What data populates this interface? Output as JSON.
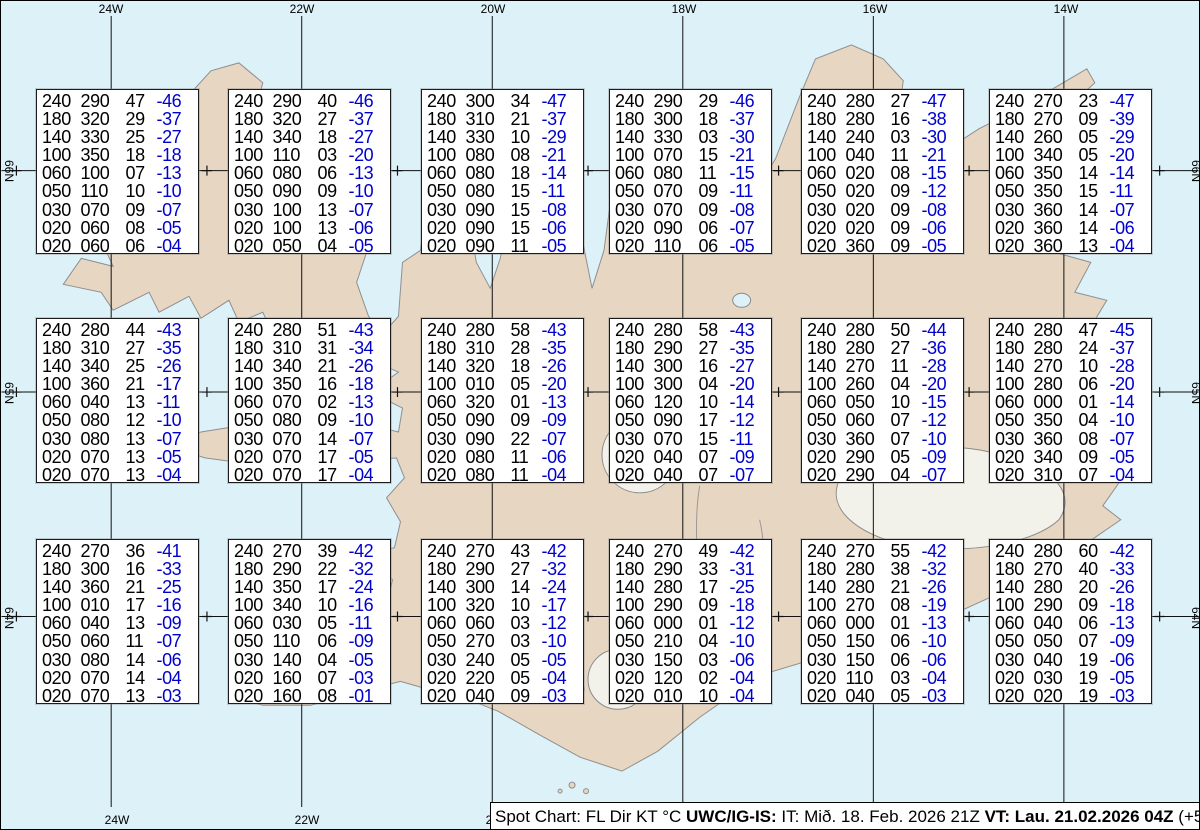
{
  "title": "Spot Chart",
  "colors": {
    "ocean": "#ddf1f8",
    "land": "#e7d6c2",
    "coastline": "#8f8f8f",
    "glacier": "#f2f1ea",
    "temperature_text": "#0000cc",
    "grid": "#111111",
    "box_background": "#ffffff"
  },
  "grid": {
    "top_labels": [
      "24W",
      "22W",
      "20W",
      "18W",
      "16W",
      "14W"
    ],
    "bottom_labels": [
      "24W",
      "22W",
      "20W",
      "18W",
      "16W",
      "14W"
    ],
    "left_labels": [
      "66N",
      "65N",
      "64N"
    ],
    "right_labels": [
      "66N",
      "65N",
      "64N"
    ]
  },
  "columns": [
    "FL",
    "Dir",
    "KT",
    "°C"
  ],
  "status_bar": {
    "segments": [
      {
        "text": "Spot Chart: FL Dir KT °C ",
        "bold": false
      },
      {
        "text": "UWC/IG-IS:",
        "bold": true
      },
      {
        "text": " IT: Mið. 18. Feb. 2026 21Z ",
        "bold": false
      },
      {
        "text": "VT: Lau. 21.02.2026 04Z",
        "bold": true
      },
      {
        "text": " (+55 h)",
        "bold": false
      }
    ]
  },
  "stations": [
    {
      "rows": [
        [
          "240",
          "290",
          "47",
          "-46"
        ],
        [
          "180",
          "320",
          "29",
          "-37"
        ],
        [
          "140",
          "330",
          "25",
          "-27"
        ],
        [
          "100",
          "350",
          "18",
          "-18"
        ],
        [
          "060",
          "100",
          "07",
          "-13"
        ],
        [
          "050",
          "110",
          "10",
          "-10"
        ],
        [
          "030",
          "070",
          "09",
          "-07"
        ],
        [
          "020",
          "060",
          "08",
          "-05"
        ],
        [
          "020",
          "060",
          "06",
          "-04"
        ]
      ]
    },
    {
      "rows": [
        [
          "240",
          "290",
          "40",
          "-46"
        ],
        [
          "180",
          "320",
          "27",
          "-37"
        ],
        [
          "140",
          "340",
          "18",
          "-27"
        ],
        [
          "100",
          "110",
          "03",
          "-20"
        ],
        [
          "060",
          "080",
          "06",
          "-13"
        ],
        [
          "050",
          "090",
          "09",
          "-10"
        ],
        [
          "030",
          "100",
          "13",
          "-07"
        ],
        [
          "020",
          "100",
          "13",
          "-06"
        ],
        [
          "020",
          "050",
          "04",
          "-05"
        ]
      ]
    },
    {
      "rows": [
        [
          "240",
          "300",
          "34",
          "-47"
        ],
        [
          "180",
          "310",
          "21",
          "-37"
        ],
        [
          "140",
          "330",
          "10",
          "-29"
        ],
        [
          "100",
          "080",
          "08",
          "-21"
        ],
        [
          "060",
          "080",
          "18",
          "-14"
        ],
        [
          "050",
          "080",
          "15",
          "-11"
        ],
        [
          "030",
          "090",
          "15",
          "-08"
        ],
        [
          "020",
          "090",
          "15",
          "-06"
        ],
        [
          "020",
          "090",
          "11",
          "-05"
        ]
      ]
    },
    {
      "rows": [
        [
          "240",
          "290",
          "29",
          "-46"
        ],
        [
          "180",
          "300",
          "18",
          "-37"
        ],
        [
          "140",
          "330",
          "03",
          "-30"
        ],
        [
          "100",
          "070",
          "15",
          "-21"
        ],
        [
          "060",
          "080",
          "11",
          "-15"
        ],
        [
          "050",
          "070",
          "09",
          "-11"
        ],
        [
          "030",
          "070",
          "09",
          "-08"
        ],
        [
          "020",
          "090",
          "06",
          "-07"
        ],
        [
          "020",
          "110",
          "06",
          "-05"
        ]
      ]
    },
    {
      "rows": [
        [
          "240",
          "280",
          "27",
          "-47"
        ],
        [
          "180",
          "280",
          "16",
          "-38"
        ],
        [
          "140",
          "240",
          "03",
          "-30"
        ],
        [
          "100",
          "040",
          "11",
          "-21"
        ],
        [
          "060",
          "020",
          "08",
          "-15"
        ],
        [
          "050",
          "020",
          "09",
          "-12"
        ],
        [
          "030",
          "020",
          "09",
          "-08"
        ],
        [
          "020",
          "020",
          "09",
          "-06"
        ],
        [
          "020",
          "360",
          "09",
          "-05"
        ]
      ]
    },
    {
      "rows": [
        [
          "240",
          "270",
          "23",
          "-47"
        ],
        [
          "180",
          "270",
          "09",
          "-39"
        ],
        [
          "140",
          "260",
          "05",
          "-29"
        ],
        [
          "100",
          "340",
          "05",
          "-20"
        ],
        [
          "060",
          "350",
          "14",
          "-14"
        ],
        [
          "050",
          "350",
          "15",
          "-11"
        ],
        [
          "030",
          "360",
          "14",
          "-07"
        ],
        [
          "020",
          "360",
          "14",
          "-06"
        ],
        [
          "020",
          "360",
          "13",
          "-04"
        ]
      ]
    },
    {
      "rows": [
        [
          "240",
          "280",
          "44",
          "-43"
        ],
        [
          "180",
          "310",
          "27",
          "-35"
        ],
        [
          "140",
          "340",
          "25",
          "-26"
        ],
        [
          "100",
          "360",
          "21",
          "-17"
        ],
        [
          "060",
          "040",
          "13",
          "-11"
        ],
        [
          "050",
          "080",
          "12",
          "-10"
        ],
        [
          "030",
          "080",
          "13",
          "-07"
        ],
        [
          "020",
          "070",
          "13",
          "-05"
        ],
        [
          "020",
          "070",
          "13",
          "-04"
        ]
      ]
    },
    {
      "rows": [
        [
          "240",
          "280",
          "51",
          "-43"
        ],
        [
          "180",
          "310",
          "31",
          "-34"
        ],
        [
          "140",
          "340",
          "21",
          "-26"
        ],
        [
          "100",
          "350",
          "16",
          "-18"
        ],
        [
          "060",
          "070",
          "02",
          "-13"
        ],
        [
          "050",
          "080",
          "09",
          "-10"
        ],
        [
          "030",
          "070",
          "14",
          "-07"
        ],
        [
          "020",
          "070",
          "17",
          "-05"
        ],
        [
          "020",
          "070",
          "17",
          "-04"
        ]
      ]
    },
    {
      "rows": [
        [
          "240",
          "280",
          "58",
          "-43"
        ],
        [
          "180",
          "310",
          "28",
          "-35"
        ],
        [
          "140",
          "320",
          "18",
          "-26"
        ],
        [
          "100",
          "010",
          "05",
          "-20"
        ],
        [
          "060",
          "320",
          "01",
          "-13"
        ],
        [
          "050",
          "090",
          "09",
          "-09"
        ],
        [
          "030",
          "090",
          "22",
          "-07"
        ],
        [
          "020",
          "080",
          "11",
          "-06"
        ],
        [
          "020",
          "080",
          "11",
          "-04"
        ]
      ]
    },
    {
      "rows": [
        [
          "240",
          "280",
          "58",
          "-43"
        ],
        [
          "180",
          "290",
          "27",
          "-35"
        ],
        [
          "140",
          "300",
          "16",
          "-27"
        ],
        [
          "100",
          "300",
          "04",
          "-20"
        ],
        [
          "060",
          "120",
          "10",
          "-14"
        ],
        [
          "050",
          "090",
          "17",
          "-12"
        ],
        [
          "030",
          "070",
          "15",
          "-11"
        ],
        [
          "020",
          "040",
          "07",
          "-09"
        ],
        [
          "020",
          "040",
          "07",
          "-07"
        ]
      ]
    },
    {
      "rows": [
        [
          "240",
          "280",
          "50",
          "-44"
        ],
        [
          "180",
          "280",
          "27",
          "-36"
        ],
        [
          "140",
          "270",
          "11",
          "-28"
        ],
        [
          "100",
          "260",
          "04",
          "-20"
        ],
        [
          "060",
          "050",
          "10",
          "-15"
        ],
        [
          "050",
          "060",
          "07",
          "-12"
        ],
        [
          "030",
          "360",
          "07",
          "-10"
        ],
        [
          "020",
          "290",
          "05",
          "-09"
        ],
        [
          "020",
          "290",
          "04",
          "-07"
        ]
      ]
    },
    {
      "rows": [
        [
          "240",
          "280",
          "47",
          "-45"
        ],
        [
          "180",
          "280",
          "24",
          "-37"
        ],
        [
          "140",
          "270",
          "10",
          "-28"
        ],
        [
          "100",
          "280",
          "06",
          "-20"
        ],
        [
          "060",
          "000",
          "01",
          "-14"
        ],
        [
          "050",
          "350",
          "04",
          "-10"
        ],
        [
          "030",
          "360",
          "08",
          "-07"
        ],
        [
          "020",
          "340",
          "09",
          "-05"
        ],
        [
          "020",
          "310",
          "07",
          "-04"
        ]
      ]
    },
    {
      "rows": [
        [
          "240",
          "270",
          "36",
          "-41"
        ],
        [
          "180",
          "300",
          "16",
          "-33"
        ],
        [
          "140",
          "360",
          "21",
          "-25"
        ],
        [
          "100",
          "010",
          "17",
          "-16"
        ],
        [
          "060",
          "040",
          "13",
          "-09"
        ],
        [
          "050",
          "060",
          "11",
          "-07"
        ],
        [
          "030",
          "080",
          "14",
          "-06"
        ],
        [
          "020",
          "070",
          "14",
          "-04"
        ],
        [
          "020",
          "070",
          "13",
          "-03"
        ]
      ]
    },
    {
      "rows": [
        [
          "240",
          "270",
          "39",
          "-42"
        ],
        [
          "180",
          "290",
          "22",
          "-32"
        ],
        [
          "140",
          "350",
          "17",
          "-24"
        ],
        [
          "100",
          "340",
          "10",
          "-16"
        ],
        [
          "060",
          "030",
          "05",
          "-11"
        ],
        [
          "050",
          "110",
          "06",
          "-09"
        ],
        [
          "030",
          "140",
          "04",
          "-05"
        ],
        [
          "020",
          "160",
          "07",
          "-03"
        ],
        [
          "020",
          "160",
          "08",
          "-01"
        ]
      ]
    },
    {
      "rows": [
        [
          "240",
          "270",
          "43",
          "-42"
        ],
        [
          "180",
          "290",
          "27",
          "-32"
        ],
        [
          "140",
          "300",
          "14",
          "-24"
        ],
        [
          "100",
          "320",
          "10",
          "-17"
        ],
        [
          "060",
          "060",
          "03",
          "-12"
        ],
        [
          "050",
          "270",
          "03",
          "-10"
        ],
        [
          "030",
          "240",
          "05",
          "-05"
        ],
        [
          "020",
          "220",
          "05",
          "-04"
        ],
        [
          "020",
          "040",
          "09",
          "-03"
        ]
      ]
    },
    {
      "rows": [
        [
          "240",
          "270",
          "49",
          "-42"
        ],
        [
          "180",
          "290",
          "33",
          "-31"
        ],
        [
          "140",
          "280",
          "17",
          "-25"
        ],
        [
          "100",
          "290",
          "09",
          "-18"
        ],
        [
          "060",
          "000",
          "01",
          "-12"
        ],
        [
          "050",
          "210",
          "04",
          "-10"
        ],
        [
          "030",
          "150",
          "03",
          "-06"
        ],
        [
          "020",
          "120",
          "02",
          "-04"
        ],
        [
          "020",
          "010",
          "10",
          "-04"
        ]
      ]
    },
    {
      "rows": [
        [
          "240",
          "270",
          "55",
          "-42"
        ],
        [
          "180",
          "280",
          "38",
          "-32"
        ],
        [
          "140",
          "280",
          "21",
          "-26"
        ],
        [
          "100",
          "270",
          "08",
          "-19"
        ],
        [
          "060",
          "000",
          "01",
          "-13"
        ],
        [
          "050",
          "150",
          "06",
          "-10"
        ],
        [
          "030",
          "150",
          "06",
          "-06"
        ],
        [
          "020",
          "110",
          "03",
          "-04"
        ],
        [
          "020",
          "040",
          "05",
          "-03"
        ]
      ]
    },
    {
      "rows": [
        [
          "240",
          "280",
          "60",
          "-42"
        ],
        [
          "180",
          "270",
          "40",
          "-33"
        ],
        [
          "140",
          "280",
          "20",
          "-26"
        ],
        [
          "100",
          "290",
          "09",
          "-18"
        ],
        [
          "060",
          "040",
          "06",
          "-13"
        ],
        [
          "050",
          "050",
          "07",
          "-09"
        ],
        [
          "030",
          "040",
          "19",
          "-06"
        ],
        [
          "020",
          "030",
          "19",
          "-05"
        ],
        [
          "020",
          "020",
          "19",
          "-03"
        ]
      ]
    }
  ]
}
